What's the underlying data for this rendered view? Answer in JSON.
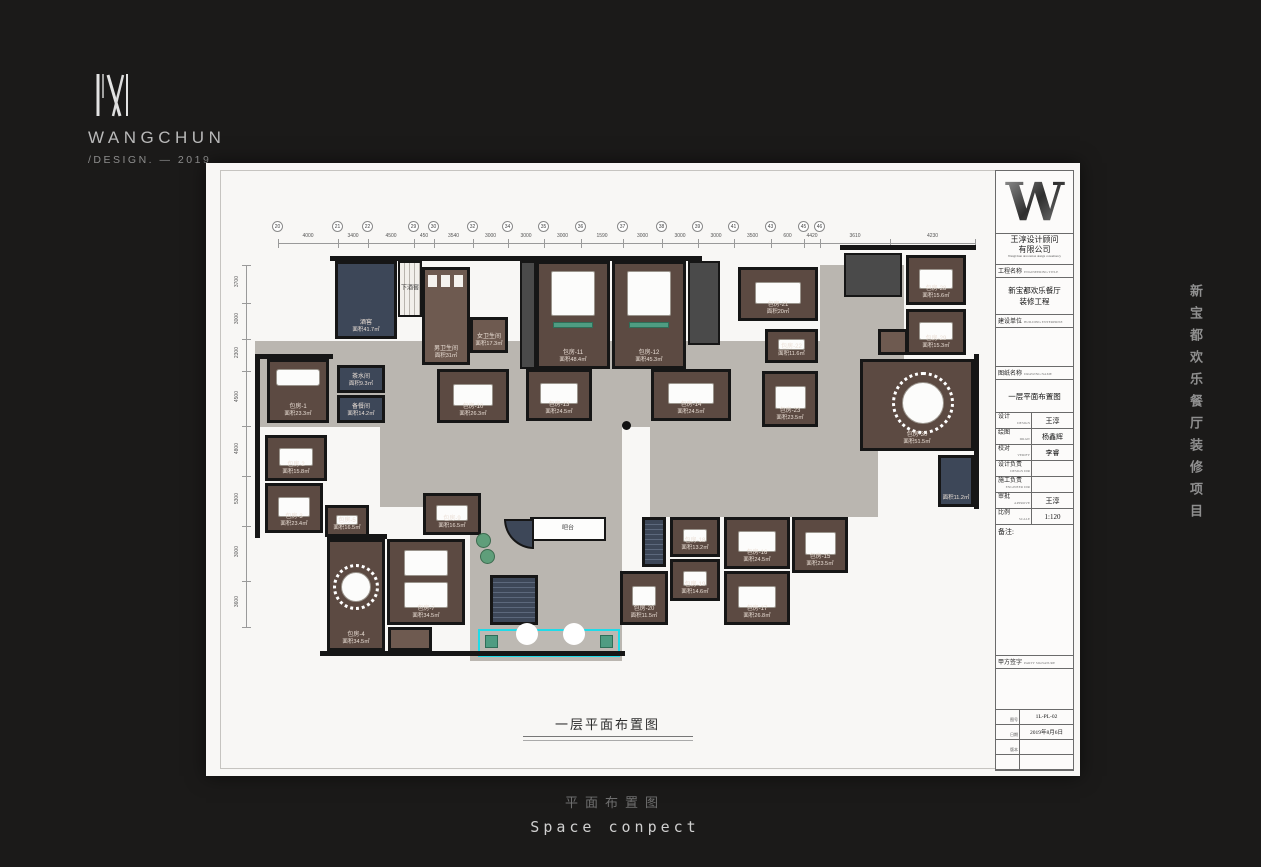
{
  "logo": {
    "brand": "WANGCHUN",
    "sub": "/DESIGN. — 2019"
  },
  "side_project_text": "新宝都欢乐餐厅装修项目",
  "footer": {
    "caption_cn": "平面布置图",
    "caption_en": "Space conpect"
  },
  "plan_caption": "一层平面布置图",
  "titleblock": {
    "logo_letter": "W",
    "company_cn1": "王淳设计顾问",
    "company_cn2": "有限公司",
    "company_en": "WangChun decoration design consultancy",
    "project_label": "工程名称",
    "project_label_en": "ENGINEERING TITLE",
    "project_lines": [
      "新宝都欢乐餐厅",
      "装修工程"
    ],
    "client_label": "建设单位",
    "client_label_en": "BUILDING ENTERPRISE",
    "drawing_label": "图纸名称",
    "drawing_label_en": "DRAWING NAME",
    "drawing_name": "一层平面布置图",
    "people": [
      {
        "label": "设计",
        "en": "DESIGN",
        "value": "王淳"
      },
      {
        "label": "绘图",
        "en": "DRAW",
        "value": "杨鑫辉"
      },
      {
        "label": "校对",
        "en": "VERIFY",
        "value": "李睿"
      },
      {
        "label": "设计负责",
        "en": "DESIGN DIR",
        "value": ""
      },
      {
        "label": "施工负责",
        "en": "ENGINEER DIR",
        "value": ""
      },
      {
        "label": "审批",
        "en": "APPROVE",
        "value": "王淳"
      },
      {
        "label": "比例",
        "en": "SCALE",
        "value": "1:120"
      }
    ],
    "remark_label": "备注:",
    "sign_label": "甲方签字",
    "sign_label_en": "PARTY SIGNATURE",
    "bottom_rows": [
      {
        "label": "图号",
        "value": "1L-PL-02"
      },
      {
        "label": "日期",
        "value": "2019年8月6日"
      },
      {
        "label": "版本",
        "value": ""
      },
      {
        "label": "",
        "value": ""
      }
    ]
  },
  "plan": {
    "colors": {
      "wall": "#161616",
      "corridor": "#bab6b0",
      "room": "#5c4a42",
      "roomText": "#eadfd6",
      "navy": "#3d4758",
      "dark": "#4a4a4a",
      "wc": "#6e5a50",
      "teal": "#4f9c82",
      "cyan": "#1fdbe8",
      "furniture": "#fcfcfb",
      "plant": "#5f9e7a"
    },
    "offset": {
      "x": 10,
      "y": 6
    },
    "corridors": [
      {
        "x": 25,
        "y": 120,
        "w": 565,
        "h": 86
      },
      {
        "x": 240,
        "y": 200,
        "w": 152,
        "h": 240
      },
      {
        "x": 420,
        "y": 206,
        "w": 210,
        "h": 90
      },
      {
        "x": 590,
        "y": 44,
        "w": 84,
        "h": 162
      },
      {
        "x": 150,
        "y": 206,
        "w": 100,
        "h": 80
      },
      {
        "x": 588,
        "y": 230,
        "w": 60,
        "h": 66
      }
    ],
    "walls": [
      {
        "x": 100,
        "y": 35,
        "w": 372,
        "h": 5
      },
      {
        "x": 610,
        "y": 24,
        "w": 136,
        "h": 5
      },
      {
        "x": 25,
        "y": 133,
        "w": 78,
        "h": 5
      },
      {
        "x": 25,
        "y": 133,
        "w": 5,
        "h": 184
      },
      {
        "x": 90,
        "y": 430,
        "w": 305,
        "h": 5
      },
      {
        "x": 744,
        "y": 133,
        "w": 5,
        "h": 155
      },
      {
        "x": 97,
        "y": 313,
        "w": 60,
        "h": 5
      }
    ],
    "rooms": [
      {
        "type": "navy",
        "x": 105,
        "y": 40,
        "w": 62,
        "h": 78,
        "label": "酒窖",
        "area": "面积41.7㎡",
        "furn": "none"
      },
      {
        "type": "stair",
        "x": 168,
        "y": 40,
        "w": 24,
        "h": 56,
        "label": "下酒窖",
        "area": "",
        "furn": "none"
      },
      {
        "type": "wc",
        "x": 192,
        "y": 46,
        "w": 48,
        "h": 98,
        "label": "男卫生间",
        "area": "面积31㎡",
        "furn": "stalls"
      },
      {
        "type": "wc",
        "x": 240,
        "y": 96,
        "w": 38,
        "h": 36,
        "label": "女卫生间",
        "area": "面积17.3㎡",
        "furn": "none"
      },
      {
        "type": "dark",
        "x": 290,
        "y": 40,
        "w": 16,
        "h": 108,
        "label": "",
        "area": "",
        "furn": "none"
      },
      {
        "type": "room",
        "x": 306,
        "y": 40,
        "w": 74,
        "h": 108,
        "label": "包房-11",
        "area": "面积48.4㎡",
        "furn": "hall"
      },
      {
        "type": "room",
        "x": 382,
        "y": 40,
        "w": 74,
        "h": 108,
        "label": "包房-12",
        "area": "面积45.3㎡",
        "furn": "hall"
      },
      {
        "type": "dark",
        "x": 458,
        "y": 40,
        "w": 32,
        "h": 84,
        "label": "",
        "area": "",
        "furn": "none"
      },
      {
        "type": "room",
        "x": 508,
        "y": 46,
        "w": 80,
        "h": 54,
        "label": "包房-21",
        "area": "面积20㎡",
        "furn": "table"
      },
      {
        "type": "dark",
        "x": 614,
        "y": 32,
        "w": 58,
        "h": 44,
        "label": "",
        "area": "",
        "furn": "none"
      },
      {
        "type": "room",
        "x": 676,
        "y": 34,
        "w": 60,
        "h": 50,
        "label": "包房-28",
        "area": "面积15.6㎡",
        "furn": "table"
      },
      {
        "type": "room",
        "x": 676,
        "y": 88,
        "w": 60,
        "h": 46,
        "label": "包房-29",
        "area": "面积15.3㎡",
        "furn": "table"
      },
      {
        "type": "room",
        "x": 630,
        "y": 138,
        "w": 114,
        "h": 92,
        "label": "包房-30",
        "area": "面积51.5㎡",
        "furn": "round-lg"
      },
      {
        "type": "navy",
        "x": 708,
        "y": 234,
        "w": 36,
        "h": 52,
        "label": "",
        "area": "面积11.2㎡",
        "furn": "none"
      },
      {
        "type": "room",
        "x": 37,
        "y": 138,
        "w": 62,
        "h": 64,
        "label": "包房-1",
        "area": "面积23.3㎡",
        "furn": "sofa"
      },
      {
        "type": "navy",
        "x": 107,
        "y": 144,
        "w": 48,
        "h": 28,
        "label": "茶水间",
        "area": "面积9.3㎡",
        "furn": "none"
      },
      {
        "type": "navy",
        "x": 107,
        "y": 174,
        "w": 48,
        "h": 28,
        "label": "备餐间",
        "area": "面积14.2㎡",
        "furn": "none"
      },
      {
        "type": "room",
        "x": 207,
        "y": 148,
        "w": 72,
        "h": 54,
        "label": "包房-10",
        "area": "面积26.3㎡",
        "furn": "table"
      },
      {
        "type": "room",
        "x": 296,
        "y": 148,
        "w": 66,
        "h": 52,
        "label": "包房-13",
        "area": "面积24.5㎡",
        "furn": "table"
      },
      {
        "type": "room",
        "x": 421,
        "y": 148,
        "w": 80,
        "h": 52,
        "label": "包房-14",
        "area": "面积24.5㎡",
        "furn": "table"
      },
      {
        "type": "room",
        "x": 535,
        "y": 108,
        "w": 53,
        "h": 34,
        "label": "包房-22",
        "area": "面积11.6㎡",
        "furn": "table-sm"
      },
      {
        "type": "room",
        "x": 532,
        "y": 150,
        "w": 56,
        "h": 56,
        "label": "包房-23",
        "area": "面积23.5㎡",
        "furn": "table"
      },
      {
        "type": "wc",
        "x": 648,
        "y": 108,
        "w": 30,
        "h": 26,
        "label": "",
        "area": "",
        "furn": "none"
      },
      {
        "type": "room",
        "x": 35,
        "y": 214,
        "w": 62,
        "h": 46,
        "label": "包房-2",
        "area": "面积15.8㎡",
        "furn": "table"
      },
      {
        "type": "room",
        "x": 35,
        "y": 262,
        "w": 58,
        "h": 50,
        "label": "包房-3",
        "area": "面积23.4㎡",
        "furn": "table"
      },
      {
        "type": "room",
        "x": 95,
        "y": 284,
        "w": 44,
        "h": 32,
        "label": "包房-5",
        "area": "面积16.5㎡",
        "furn": "table-sm"
      },
      {
        "type": "room",
        "x": 193,
        "y": 272,
        "w": 58,
        "h": 42,
        "label": "包房-9",
        "area": "面积16.5㎡",
        "furn": "table"
      },
      {
        "type": "room",
        "x": 97,
        "y": 318,
        "w": 58,
        "h": 112,
        "label": "包房-4",
        "area": "面积34.5㎡",
        "furn": "round"
      },
      {
        "type": "room",
        "x": 157,
        "y": 318,
        "w": 78,
        "h": 86,
        "label": "包房-7",
        "area": "面积34.5㎡",
        "furn": "twin"
      },
      {
        "type": "wc",
        "x": 158,
        "y": 406,
        "w": 44,
        "h": 24,
        "label": "",
        "area": "",
        "furn": "none"
      },
      {
        "type": "navyStair",
        "x": 260,
        "y": 354,
        "w": 48,
        "h": 50,
        "label": "",
        "area": "",
        "furn": "none"
      },
      {
        "type": "bar",
        "x": 300,
        "y": 296,
        "w": 76,
        "h": 24,
        "label": "吧台",
        "area": "",
        "furn": "none"
      },
      {
        "type": "navyQ",
        "x": 274,
        "y": 298,
        "w": 30,
        "h": 30,
        "label": "",
        "area": "",
        "furn": "none"
      },
      {
        "type": "navyStair",
        "x": 412,
        "y": 296,
        "w": 24,
        "h": 50,
        "label": "",
        "area": "",
        "furn": "none"
      },
      {
        "type": "room",
        "x": 390,
        "y": 350,
        "w": 48,
        "h": 54,
        "label": "包房-20",
        "area": "面积11.5㎡",
        "furn": "table-sm"
      },
      {
        "type": "room",
        "x": 440,
        "y": 296,
        "w": 50,
        "h": 40,
        "label": "包房-18",
        "area": "面积13.2㎡",
        "furn": "table-sm"
      },
      {
        "type": "room",
        "x": 440,
        "y": 338,
        "w": 50,
        "h": 42,
        "label": "包房-19",
        "area": "面积14.6㎡",
        "furn": "table-sm"
      },
      {
        "type": "room",
        "x": 494,
        "y": 296,
        "w": 66,
        "h": 52,
        "label": "包房-16",
        "area": "面积24.5㎡",
        "furn": "table"
      },
      {
        "type": "room",
        "x": 494,
        "y": 350,
        "w": 66,
        "h": 54,
        "label": "包房-17",
        "area": "面积26.8㎡",
        "furn": "table"
      },
      {
        "type": "room",
        "x": 562,
        "y": 296,
        "w": 56,
        "h": 56,
        "label": "包房-15",
        "area": "面积23.5㎡",
        "furn": "table"
      }
    ],
    "entrance": {
      "x": 248,
      "y": 408,
      "w": 142,
      "h": 28
    },
    "plants": [
      {
        "x": 246,
        "y": 312
      },
      {
        "x": 250,
        "y": 328
      }
    ],
    "columns": [
      {
        "x": 392,
        "y": 200
      }
    ],
    "grid_top": {
      "line_y": 22,
      "ticks": [
        48,
        108,
        138,
        184,
        204,
        243,
        278,
        314,
        351,
        393,
        432,
        468,
        504,
        541,
        574,
        590,
        660,
        745
      ],
      "bubbles": [
        "20",
        "21",
        "22",
        "29",
        "30",
        "32",
        "34",
        "35",
        "36",
        "37",
        "38",
        "39",
        "41",
        "43",
        "45",
        "46"
      ],
      "dims": [
        "4000",
        "3400",
        "4500",
        "450",
        "3540",
        "3000",
        "3000",
        "3000",
        "1590",
        "3000",
        "3000",
        "3000",
        "3500",
        "600",
        "4420",
        "3610",
        "4230"
      ]
    },
    "grid_left": {
      "line_x": 16,
      "ticks": [
        44,
        82,
        118,
        150,
        205,
        255,
        305,
        360,
        406
      ],
      "dims": [
        "3700",
        "3000",
        "2300",
        "4500",
        "4800",
        "5300",
        "3000",
        "3600"
      ]
    }
  }
}
